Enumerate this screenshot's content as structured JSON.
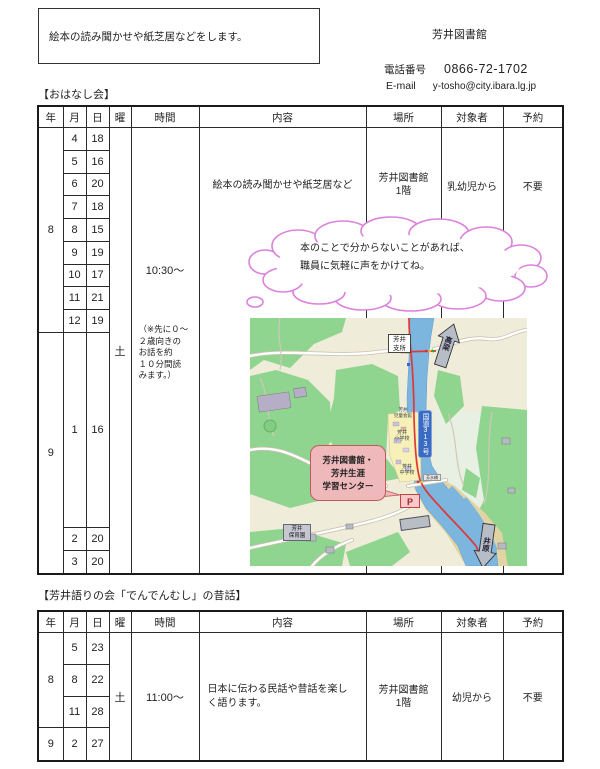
{
  "header": {
    "notice_box": "絵本の読み聞かせや紙芝居などをします。",
    "library_name": "芳井図書館",
    "phone_label": "電話番号",
    "phone_number": "0866-72-1702",
    "email_label": "E-mail",
    "email_address": "y-tosho@city.ibara.lg.jp"
  },
  "ohanashi": {
    "title": "【おはなし会】",
    "columns": [
      "年",
      "月",
      "日",
      "曜",
      "時間",
      "内容",
      "場所",
      "対象者",
      "予約"
    ],
    "year1": "8",
    "year2": "9",
    "rows": [
      {
        "month": "4",
        "day": "18"
      },
      {
        "month": "5",
        "day": "16"
      },
      {
        "month": "6",
        "day": "20"
      },
      {
        "month": "7",
        "day": "18"
      },
      {
        "month": "8",
        "day": "15"
      },
      {
        "month": "9",
        "day": "19"
      },
      {
        "month": "10",
        "day": "17"
      },
      {
        "month": "11",
        "day": "21"
      },
      {
        "month": "12",
        "day": "19"
      },
      {
        "month": "1",
        "day": "16"
      },
      {
        "month": "2",
        "day": "20"
      },
      {
        "month": "3",
        "day": "20"
      }
    ],
    "weekday": "土",
    "time": "10:30～",
    "time_note": "（※先に０～\n２歳向きの\nお話を約\n１０分間読\nみます。）",
    "content": "絵本の読み聞かせや紙芝居など",
    "place": "芳井図書館\n1階",
    "audience": "乳幼児から",
    "reservation": "不要"
  },
  "cloud": {
    "text": "本のことで分からないことがあれば、\n職員に気軽に声をかけてね。",
    "outline_color": "#dc82dc"
  },
  "map": {
    "branch_office": "芳井\n支所",
    "route_sign": "国道313号",
    "to_north": "高梁",
    "to_south": "井原",
    "children_hall": "芳井\n児童会館",
    "elementary_school": "芳井\n小学校",
    "junior_high_school": "芳井\n中学校",
    "bridge": "芳水橋",
    "library_callout": "芳井図書館・\n芳井生涯\n学習センター",
    "parking": "P",
    "nursery": "芳井\n保育園"
  },
  "denden": {
    "title": "【芳井語りの会「でんでんむし」の昔話】",
    "columns": [
      "年",
      "月",
      "日",
      "曜",
      "時間",
      "内容",
      "場所",
      "対象者",
      "予約"
    ],
    "year1": "8",
    "year2": "9",
    "rows": [
      {
        "month": "5",
        "day": "23"
      },
      {
        "month": "8",
        "day": "22"
      },
      {
        "month": "11",
        "day": "28"
      },
      {
        "month": "2",
        "day": "27"
      }
    ],
    "weekday": "土",
    "time": "11:00～",
    "content": "日本に伝わる民話や昔話を楽し\nく語ります。",
    "place": "芳井図書館\n1階",
    "audience": "幼児から",
    "reservation": "不要"
  }
}
